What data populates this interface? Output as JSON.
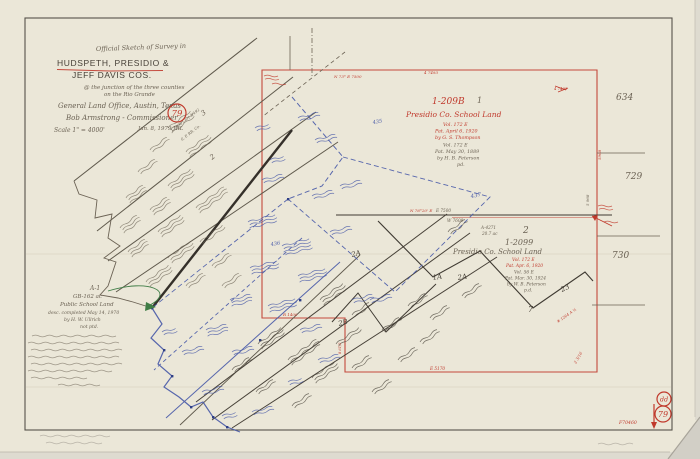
{
  "page": {
    "description": "Scanned hand-drawn official survey sketch, General Land Office map of Hudspeth, Presidio and Jeff Davis Counties at the Rio Grande",
    "paper_color": "#ebe7d8",
    "border_color": "#56524a"
  },
  "map": {
    "colors": {
      "pencil": "#6b6254",
      "dark": "#474138",
      "red": "#c0392c",
      "blue": "#4759a8",
      "green": "#3f7d46",
      "faint": "#9a948a"
    },
    "labels": [
      {
        "n": "title-line-1",
        "t": "Official Sketch of Survey in",
        "x": 96,
        "y": 51,
        "s": 6.5,
        "c": "pencil",
        "f": "script",
        "r": -2
      },
      {
        "n": "title-county-line-1",
        "t": "HUDSPETH, PRESIDIO &",
        "x": 57,
        "y": 66,
        "s": 8.5,
        "c": "dark",
        "f": "print"
      },
      {
        "n": "title-county-line-2",
        "t": "JEFF DAVIS COS.",
        "x": 72,
        "y": 78,
        "s": 8.5,
        "c": "dark",
        "f": "print"
      },
      {
        "n": "title-sub-1",
        "t": "@ the junction of the three counties",
        "x": 84,
        "y": 89,
        "s": 5.5,
        "c": "pencil",
        "f": "script"
      },
      {
        "n": "title-sub-2",
        "t": "on the Rio Grande",
        "x": 104,
        "y": 96,
        "s": 5.5,
        "c": "pencil",
        "f": "script"
      },
      {
        "n": "title-office",
        "t": "General Land Office, Austin, Texas",
        "x": 58,
        "y": 108,
        "s": 7,
        "c": "pencil",
        "f": "script"
      },
      {
        "n": "title-commissioner",
        "t": "Bob Armstrong - Commissioner",
        "x": 66,
        "y": 120,
        "s": 7,
        "c": "pencil",
        "f": "script"
      },
      {
        "n": "title-scale",
        "t": "Scale 1\" = 4000'",
        "x": 54,
        "y": 132,
        "s": 6,
        "c": "pencil",
        "f": "script"
      },
      {
        "n": "title-date",
        "t": "Jan. 8, 1979  JRL",
        "x": 138,
        "y": 130,
        "s": 5.5,
        "c": "pencil",
        "f": "script"
      },
      {
        "n": "survey-1-number",
        "t": "1",
        "x": 477,
        "y": 103,
        "s": 8,
        "c": "pencil",
        "f": "script"
      },
      {
        "n": "block-209b-file",
        "t": "1-209B",
        "x": 432,
        "y": 104,
        "s": 9,
        "c": "red",
        "f": "script"
      },
      {
        "n": "block-209b-name",
        "t": "Presidio Co. School Land",
        "x": 406,
        "y": 117,
        "s": 7.5,
        "c": "red",
        "f": "script"
      },
      {
        "n": "block-209b-vol",
        "t": "Vol. 172 E",
        "x": 443,
        "y": 126,
        "s": 4.8,
        "c": "red",
        "f": "script"
      },
      {
        "n": "block-209b-pat1",
        "t": "Pat. April 6, 1920",
        "x": 435,
        "y": 132.5,
        "s": 4.8,
        "c": "red",
        "f": "script"
      },
      {
        "n": "block-209b-surveyor1",
        "t": "by G. S. Thompson",
        "x": 435,
        "y": 139,
        "s": 4.8,
        "c": "red",
        "f": "script"
      },
      {
        "n": "block-209b-vol2",
        "t": "Vol. 172 E",
        "x": 443,
        "y": 146.5,
        "s": 4.8,
        "c": "pencil",
        "f": "script"
      },
      {
        "n": "block-209b-pat2",
        "t": "Pat. May 30, 1889",
        "x": 435,
        "y": 153,
        "s": 4.8,
        "c": "pencil",
        "f": "script"
      },
      {
        "n": "block-209b-surveyor2",
        "t": "by H. B. Peterson",
        "x": 437,
        "y": 159.5,
        "s": 4.8,
        "c": "pencil",
        "f": "script"
      },
      {
        "n": "block-209b-pd",
        "t": "pd.",
        "x": 457,
        "y": 166,
        "s": 4.8,
        "c": "pencil",
        "f": "script"
      },
      {
        "n": "margin-number-634",
        "t": "634",
        "x": 616,
        "y": 100,
        "s": 9,
        "c": "pencil",
        "f": "script"
      },
      {
        "n": "margin-number-729",
        "t": "729",
        "x": 625,
        "y": 179,
        "s": 9,
        "c": "pencil",
        "f": "script"
      },
      {
        "n": "margin-number-730",
        "t": "730",
        "x": 612,
        "y": 258,
        "s": 9,
        "c": "pencil",
        "f": "script"
      },
      {
        "n": "survey-2-number",
        "t": "2",
        "x": 523,
        "y": 233,
        "s": 9,
        "c": "pencil",
        "f": "script"
      },
      {
        "n": "abstract-4271",
        "t": "A-4271",
        "x": 481,
        "y": 229,
        "s": 4.2,
        "c": "pencil",
        "f": "script"
      },
      {
        "n": "abstract-4271-acres",
        "t": "20.7 ac",
        "x": 482,
        "y": 235,
        "s": 4.2,
        "c": "pencil",
        "f": "script"
      },
      {
        "n": "block-2099-file",
        "t": "1-2099",
        "x": 505,
        "y": 245,
        "s": 8,
        "c": "pencil",
        "f": "script"
      },
      {
        "n": "block-2099-name",
        "t": "Presidio Co. School Land",
        "x": 453,
        "y": 254,
        "s": 7,
        "c": "pencil",
        "f": "script"
      },
      {
        "n": "block-2099-vol",
        "t": "Vol. 172 E",
        "x": 512,
        "y": 261,
        "s": 4.4,
        "c": "red",
        "f": "script"
      },
      {
        "n": "block-2099-pat1",
        "t": "Pat. Apr. 6, 1920",
        "x": 506,
        "y": 267,
        "s": 4.4,
        "c": "red",
        "f": "script"
      },
      {
        "n": "block-2099-vol2",
        "t": "Vol. 56 E",
        "x": 514,
        "y": 273.5,
        "s": 4.4,
        "c": "pencil",
        "f": "script"
      },
      {
        "n": "block-2099-pat2",
        "t": "Pat. Mar. 30, 1924",
        "x": 505,
        "y": 279.5,
        "s": 4.4,
        "c": "pencil",
        "f": "script"
      },
      {
        "n": "block-2099-surveyor",
        "t": "by W. B. Peterson",
        "x": 507,
        "y": 285.5,
        "s": 4.4,
        "c": "pencil",
        "f": "script"
      },
      {
        "n": "block-2099-pd",
        "t": "p.d.",
        "x": 524,
        "y": 291.5,
        "s": 4.4,
        "c": "pencil",
        "f": "script"
      },
      {
        "n": "tract-1a",
        "t": "1A",
        "x": 433,
        "y": 280,
        "s": 7,
        "c": "dark",
        "f": "script",
        "r": -10
      },
      {
        "n": "tract-2a",
        "t": "2A",
        "x": 458,
        "y": 280,
        "s": 7,
        "c": "dark",
        "f": "script",
        "r": -10
      },
      {
        "n": "tract-2a-west",
        "t": "2A",
        "x": 352,
        "y": 257,
        "s": 7,
        "c": "dark",
        "f": "script",
        "r": -15
      },
      {
        "n": "tract-7",
        "t": "7",
        "x": 528,
        "y": 312,
        "s": 8,
        "c": "dark",
        "f": "script"
      },
      {
        "n": "tract-23",
        "t": "23",
        "x": 562,
        "y": 292,
        "s": 7,
        "c": "dark",
        "f": "script",
        "r": -25
      },
      {
        "n": "tract-2b",
        "t": "2B",
        "x": 339,
        "y": 326,
        "s": 7,
        "c": "dark",
        "f": "script",
        "r": -15
      },
      {
        "n": "strip-survey-3",
        "t": "3",
        "x": 203,
        "y": 116,
        "s": 7,
        "c": "pencil",
        "f": "script",
        "r": -38
      },
      {
        "n": "strip-survey-2",
        "t": "2",
        "x": 212,
        "y": 160,
        "s": 7,
        "c": "pencil",
        "f": "script",
        "r": -38
      },
      {
        "n": "strip-cert-line-1",
        "t": "1-7990 Cert 3/492",
        "x": 172,
        "y": 132,
        "s": 3.8,
        "c": "pencil",
        "f": "script",
        "r": -38
      },
      {
        "n": "strip-cert-line-2",
        "t": "S. P. RR. Co.",
        "x": 182,
        "y": 141,
        "s": 3.8,
        "c": "pencil",
        "f": "script",
        "r": -38
      },
      {
        "n": "blue-survey-435",
        "t": "435",
        "x": 373,
        "y": 124,
        "s": 5,
        "c": "blue",
        "f": "script",
        "r": -10
      },
      {
        "n": "blue-survey-437",
        "t": "437",
        "x": 471,
        "y": 198,
        "s": 5.5,
        "c": "blue",
        "f": "script",
        "r": -10
      },
      {
        "n": "blue-survey-436",
        "t": "436",
        "x": 271,
        "y": 246,
        "s": 5,
        "c": "blue",
        "f": "script",
        "r": -10
      },
      {
        "n": "tract-a1-label",
        "t": "A-1",
        "x": 90,
        "y": 290,
        "s": 6,
        "c": "pencil",
        "f": "script"
      },
      {
        "n": "tract-a1-acres",
        "t": "GB-162 ac",
        "x": 73,
        "y": 298,
        "s": 5.5,
        "c": "pencil",
        "f": "script"
      },
      {
        "n": "tract-a1-name",
        "t": "Public School Land",
        "x": 60,
        "y": 306,
        "s": 5.5,
        "c": "pencil",
        "f": "script"
      },
      {
        "n": "tract-a1-desc",
        "t": "desc. completed May 14, 1970",
        "x": 48,
        "y": 314,
        "s": 4.6,
        "c": "pencil",
        "f": "script"
      },
      {
        "n": "tract-a1-by",
        "t": "by H. W. Ullrich",
        "x": 64,
        "y": 321,
        "s": 4.6,
        "c": "pencil",
        "f": "script"
      },
      {
        "n": "tract-a1-notptd",
        "t": "not ptd.",
        "x": 80,
        "y": 328,
        "s": 4.6,
        "c": "pencil",
        "f": "script"
      },
      {
        "n": "bearing-top-red",
        "t": "N 73° E  7500",
        "x": 334,
        "y": 78,
        "s": 4,
        "c": "red",
        "f": "script"
      },
      {
        "n": "bearing-top-red-2",
        "t": "4 7493",
        "x": 424,
        "y": 74,
        "s": 4,
        "c": "red",
        "f": "script"
      },
      {
        "n": "bearing-mid-e7500",
        "t": "E 7500",
        "x": 436,
        "y": 212,
        "s": 4.2,
        "c": "pencil",
        "f": "script"
      },
      {
        "n": "bearing-mid-w7600",
        "t": "W 7600",
        "x": 447,
        "y": 222,
        "s": 4.2,
        "c": "pencil",
        "f": "script"
      },
      {
        "n": "bearing-mid-red",
        "t": "N 76°20' E",
        "x": 410,
        "y": 212,
        "s": 4,
        "c": "red",
        "f": "script"
      },
      {
        "n": "bearing-r1400",
        "t": "R 1400",
        "x": 283,
        "y": 316,
        "s": 4,
        "c": "red",
        "f": "script"
      },
      {
        "n": "bearing-bottom-e5170",
        "t": "E  5170",
        "x": 430,
        "y": 370,
        "s": 4.2,
        "c": "red",
        "f": "script"
      },
      {
        "n": "bearing-right-5968",
        "t": "5968",
        "x": 601,
        "y": 160,
        "s": 4,
        "c": "red",
        "f": "script",
        "r": -90
      },
      {
        "n": "bearing-right-5968-pencil",
        "t": "5 968",
        "x": 589,
        "y": 206,
        "s": 4,
        "c": "pencil",
        "f": "script",
        "r": -90
      },
      {
        "n": "bearing-right-2316",
        "t": "2 3/16",
        "x": 576,
        "y": 364,
        "s": 4,
        "c": "red",
        "f": "script",
        "r": -60
      },
      {
        "n": "bearing-right-1264",
        "t": "# 1264 A ½",
        "x": 558,
        "y": 323,
        "s": 3.8,
        "c": "red",
        "f": "script",
        "r": -35
      },
      {
        "n": "bearing-left-861",
        "t": "8 61/2",
        "x": 341,
        "y": 354,
        "s": 3.6,
        "c": "red",
        "f": "script",
        "r": -90
      },
      {
        "n": "red-tick-note",
        "t": "4 7493",
        "x": 554,
        "y": 90,
        "s": 3.8,
        "c": "red",
        "f": "script"
      },
      {
        "n": "file-number",
        "t": "F70460",
        "x": 619,
        "y": 424,
        "s": 4.6,
        "c": "red",
        "f": "script"
      }
    ],
    "stamps": [
      {
        "n": "stamp-sheet-79-top",
        "t": "79",
        "cx": 177,
        "cy": 113,
        "rad": 9,
        "s": 8.5
      },
      {
        "n": "stamp-monogram",
        "t": "dd",
        "cx": 664,
        "cy": 399,
        "rad": 7,
        "s": 6.5
      },
      {
        "n": "stamp-sheet-79-bottom",
        "t": "79",
        "cx": 663,
        "cy": 414,
        "rad": 8,
        "s": 8
      }
    ]
  }
}
